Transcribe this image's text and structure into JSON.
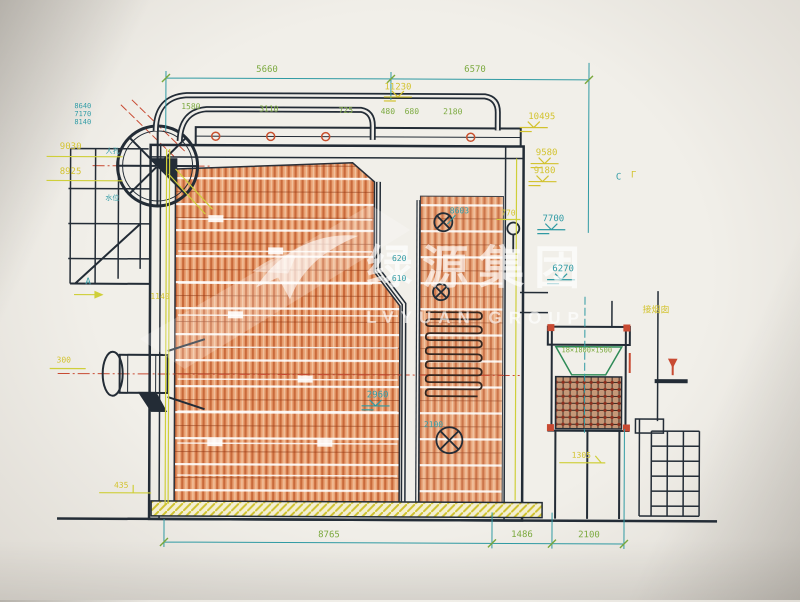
{
  "colors": {
    "teal": "#2f9aa3",
    "yellow": "#d2c22e",
    "green": "#7aa badge",
    "green_fix": "#7aa83c",
    "white": "#ffffff"
  },
  "watermark": {
    "cn": "绿源集团",
    "en": "LVYUAN GROUP"
  },
  "labels": [
    {
      "name": "dim-5660",
      "text": "5660",
      "x": 266,
      "y": 71,
      "color": "green_fix"
    },
    {
      "name": "dim-6570",
      "text": "6570",
      "x": 474,
      "y": 70,
      "color": "green_fix"
    },
    {
      "name": "elev-11230",
      "text": "11230",
      "x": 397,
      "y": 88,
      "color": "yellow"
    },
    {
      "name": "dim-1580",
      "text": "1580",
      "x": 190,
      "y": 108,
      "color": "green_fix",
      "size": 8
    },
    {
      "name": "dim-3110",
      "text": "3110",
      "x": 268,
      "y": 110,
      "color": "green_fix",
      "size": 8
    },
    {
      "name": "dim-725",
      "text": "725",
      "x": 345,
      "y": 111,
      "color": "green_fix",
      "size": 8
    },
    {
      "name": "dim-480",
      "text": "480",
      "x": 387,
      "y": 112,
      "color": "green_fix",
      "size": 8
    },
    {
      "name": "dim-680",
      "text": "680",
      "x": 411,
      "y": 112,
      "color": "green_fix",
      "size": 8
    },
    {
      "name": "dim-2180",
      "text": "2180",
      "x": 452,
      "y": 112,
      "color": "green_fix",
      "size": 8
    },
    {
      "name": "elev-10495",
      "text": "10495",
      "x": 541,
      "y": 117,
      "color": "yellow"
    },
    {
      "name": "elev-9580",
      "text": "9580",
      "x": 546,
      "y": 153,
      "color": "yellow"
    },
    {
      "name": "elev-9180",
      "text": "9180",
      "x": 544,
      "y": 171,
      "color": "yellow"
    },
    {
      "name": "elev-7700",
      "text": "7700",
      "x": 553,
      "y": 219,
      "color": "teal"
    },
    {
      "name": "dim-770",
      "text": "770",
      "x": 508,
      "y": 213,
      "color": "yellow",
      "size": 8
    },
    {
      "name": "elev-6270",
      "text": "6270",
      "x": 563,
      "y": 269,
      "color": "teal"
    },
    {
      "name": "section-c",
      "text": "C",
      "x": 618,
      "y": 177,
      "color": "teal"
    },
    {
      "name": "section-c-mark",
      "text": "Γ",
      "x": 633,
      "y": 175,
      "color": "yellow"
    },
    {
      "name": "elev-8603",
      "text": "8603",
      "x": 459,
      "y": 211,
      "color": "teal",
      "size": 8
    },
    {
      "name": "dim-620",
      "text": "620",
      "x": 399,
      "y": 259,
      "color": "teal",
      "size": 8
    },
    {
      "name": "dim-610",
      "text": "610",
      "x": 399,
      "y": 279,
      "color": "teal",
      "size": 8
    },
    {
      "name": "elev-9030",
      "text": "9030",
      "x": 70,
      "y": 149,
      "color": "yellow"
    },
    {
      "name": "elev-8925",
      "text": "8925",
      "x": 70,
      "y": 174,
      "color": "yellow"
    },
    {
      "name": "dim-8640",
      "text": "8640",
      "x": 82,
      "y": 108,
      "color": "teal",
      "size": 7
    },
    {
      "name": "dim-7170",
      "text": "7170",
      "x": 82,
      "y": 116,
      "color": "teal",
      "size": 7
    },
    {
      "name": "dim-8140",
      "text": "8140",
      "x": 82,
      "y": 124,
      "color": "teal",
      "size": 7
    },
    {
      "name": "tiny-label-drum-1",
      "text": "人孔",
      "x": 112,
      "y": 153,
      "color": "teal",
      "size": 7
    },
    {
      "name": "tiny-label-drum-2",
      "text": "水位",
      "x": 112,
      "y": 200,
      "color": "teal",
      "size": 7
    },
    {
      "name": "view-a",
      "text": "A",
      "x": 88,
      "y": 284,
      "color": "teal"
    },
    {
      "name": "dim-1140",
      "text": "1140",
      "x": 160,
      "y": 298,
      "color": "yellow",
      "size": 8
    },
    {
      "name": "dim-300",
      "text": "300",
      "x": 64,
      "y": 362,
      "color": "yellow",
      "size": 8
    },
    {
      "name": "elev-2960",
      "text": "2960",
      "x": 378,
      "y": 396,
      "color": "teal"
    },
    {
      "name": "elev-2100-mid",
      "text": "2100",
      "x": 434,
      "y": 425,
      "color": "teal",
      "size": 8
    },
    {
      "name": "dim-435",
      "text": "435",
      "x": 122,
      "y": 487,
      "color": "yellow",
      "size": 8
    },
    {
      "name": "dim-1305",
      "text": "1305",
      "x": 582,
      "y": 455,
      "color": "yellow",
      "size": 8
    },
    {
      "name": "dim-8765",
      "text": "8765",
      "x": 330,
      "y": 536,
      "color": "green_fix"
    },
    {
      "name": "dim-1486",
      "text": "1486",
      "x": 523,
      "y": 535,
      "color": "green_fix"
    },
    {
      "name": "dim-2100",
      "text": "2100",
      "x": 590,
      "y": 535,
      "color": "green_fix"
    },
    {
      "name": "equip-size",
      "text": "18×1800×1500",
      "x": 587,
      "y": 350,
      "color": "green_fix",
      "size": 7
    },
    {
      "name": "to-chimney",
      "text": "接烟囱",
      "x": 656,
      "y": 310,
      "color": "yellow",
      "size": 9
    }
  ]
}
